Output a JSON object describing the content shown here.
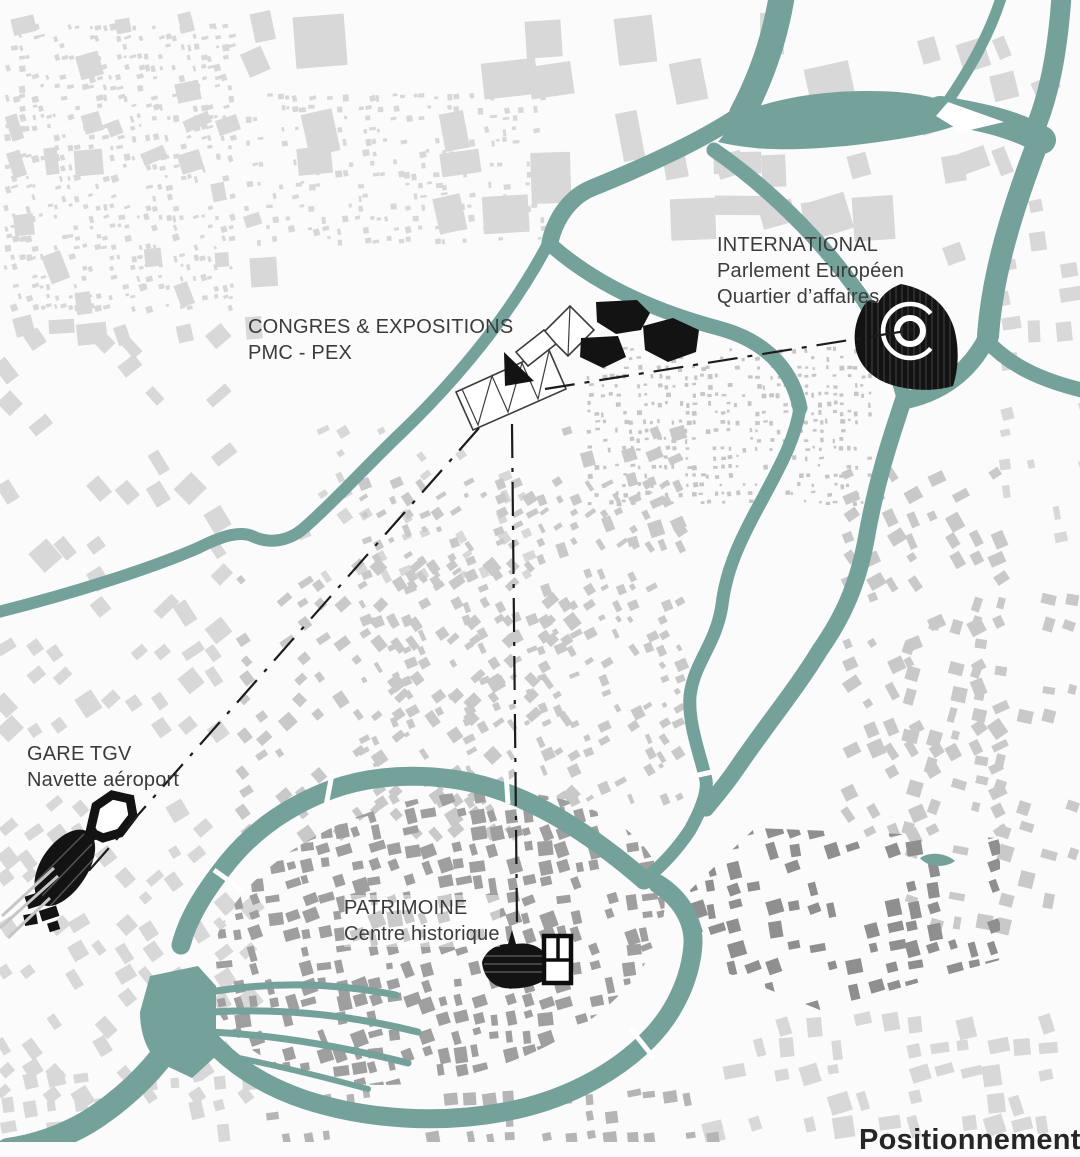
{
  "map": {
    "caption": "Positionnement",
    "labels": {
      "international": {
        "title": "INTERNATIONAL",
        "sub1": "Parlement Européen",
        "sub2": "Quartier d’affaires"
      },
      "congres": {
        "title": "CONGRES & EXPOSITIONS",
        "sub1": "PMC - PEX"
      },
      "gare": {
        "title": "GARE TGV",
        "sub1": "Navette aéroport"
      },
      "patrimoine": {
        "title": "PATRIMOINE",
        "sub1": "Centre historique"
      }
    },
    "colors": {
      "water": "#75a19b",
      "background": "#fbfbfb",
      "fabric_light": "#d8d8d8",
      "fabric_mid": "#c9c9c9",
      "fabric_stipple": "#c6c6c6",
      "island": "#9f9f9f",
      "district_dark": "#8f8f8f",
      "south_band": "#b5b5b5",
      "icon_black": "#131313",
      "connector": "#1c1c1c",
      "text": "#3b3b3b"
    }
  }
}
